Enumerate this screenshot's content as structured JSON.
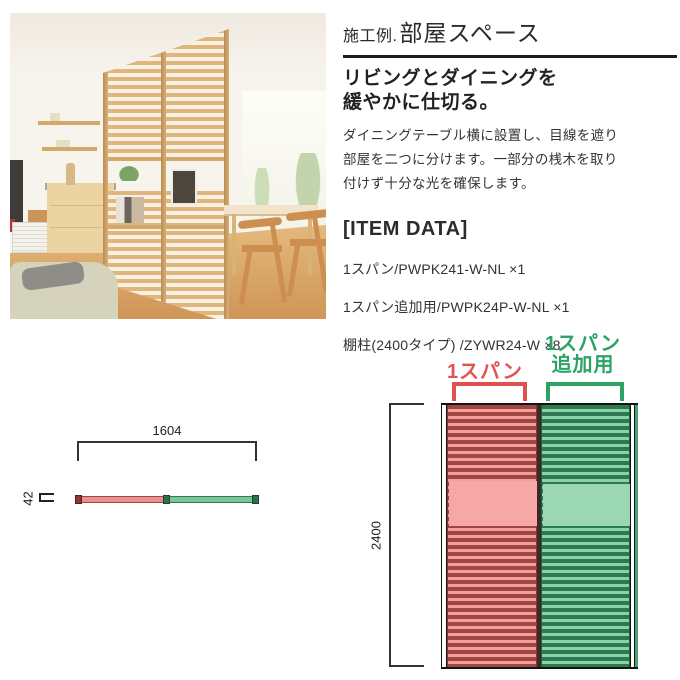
{
  "colors": {
    "accent_red": "#e25453",
    "accent_green": "#2ba266",
    "text_dark": "#2b2b2b"
  },
  "info": {
    "title_prefix": "施工例.",
    "title_main": "部屋スペース",
    "subtitle_line1": "リビングとダイニングを",
    "subtitle_line2": "緩やかに仕切る。",
    "body_line1": "ダイニングテーブル横に設置し、目線を遮り",
    "body_line2": "部屋を二つに分けます。一部分の桟木を取り",
    "body_line3": "付けず十分な光を確保します。",
    "item_data_heading": "[ITEM DATA]",
    "items": [
      "1スパン/PWPK241-W-NL ×1",
      "1スパン追加用/PWPK24P-W-NL ×1",
      "棚柱(2400タイプ) /ZYWR24-W ×8"
    ]
  },
  "diagram": {
    "top_view": {
      "width_mm": "1604",
      "depth_mm": "42"
    },
    "front_view": {
      "height_mm": "2400",
      "span1_label": "1スパン",
      "span2_label_line1": "1スパン",
      "span2_label_line2": "追加用"
    }
  }
}
